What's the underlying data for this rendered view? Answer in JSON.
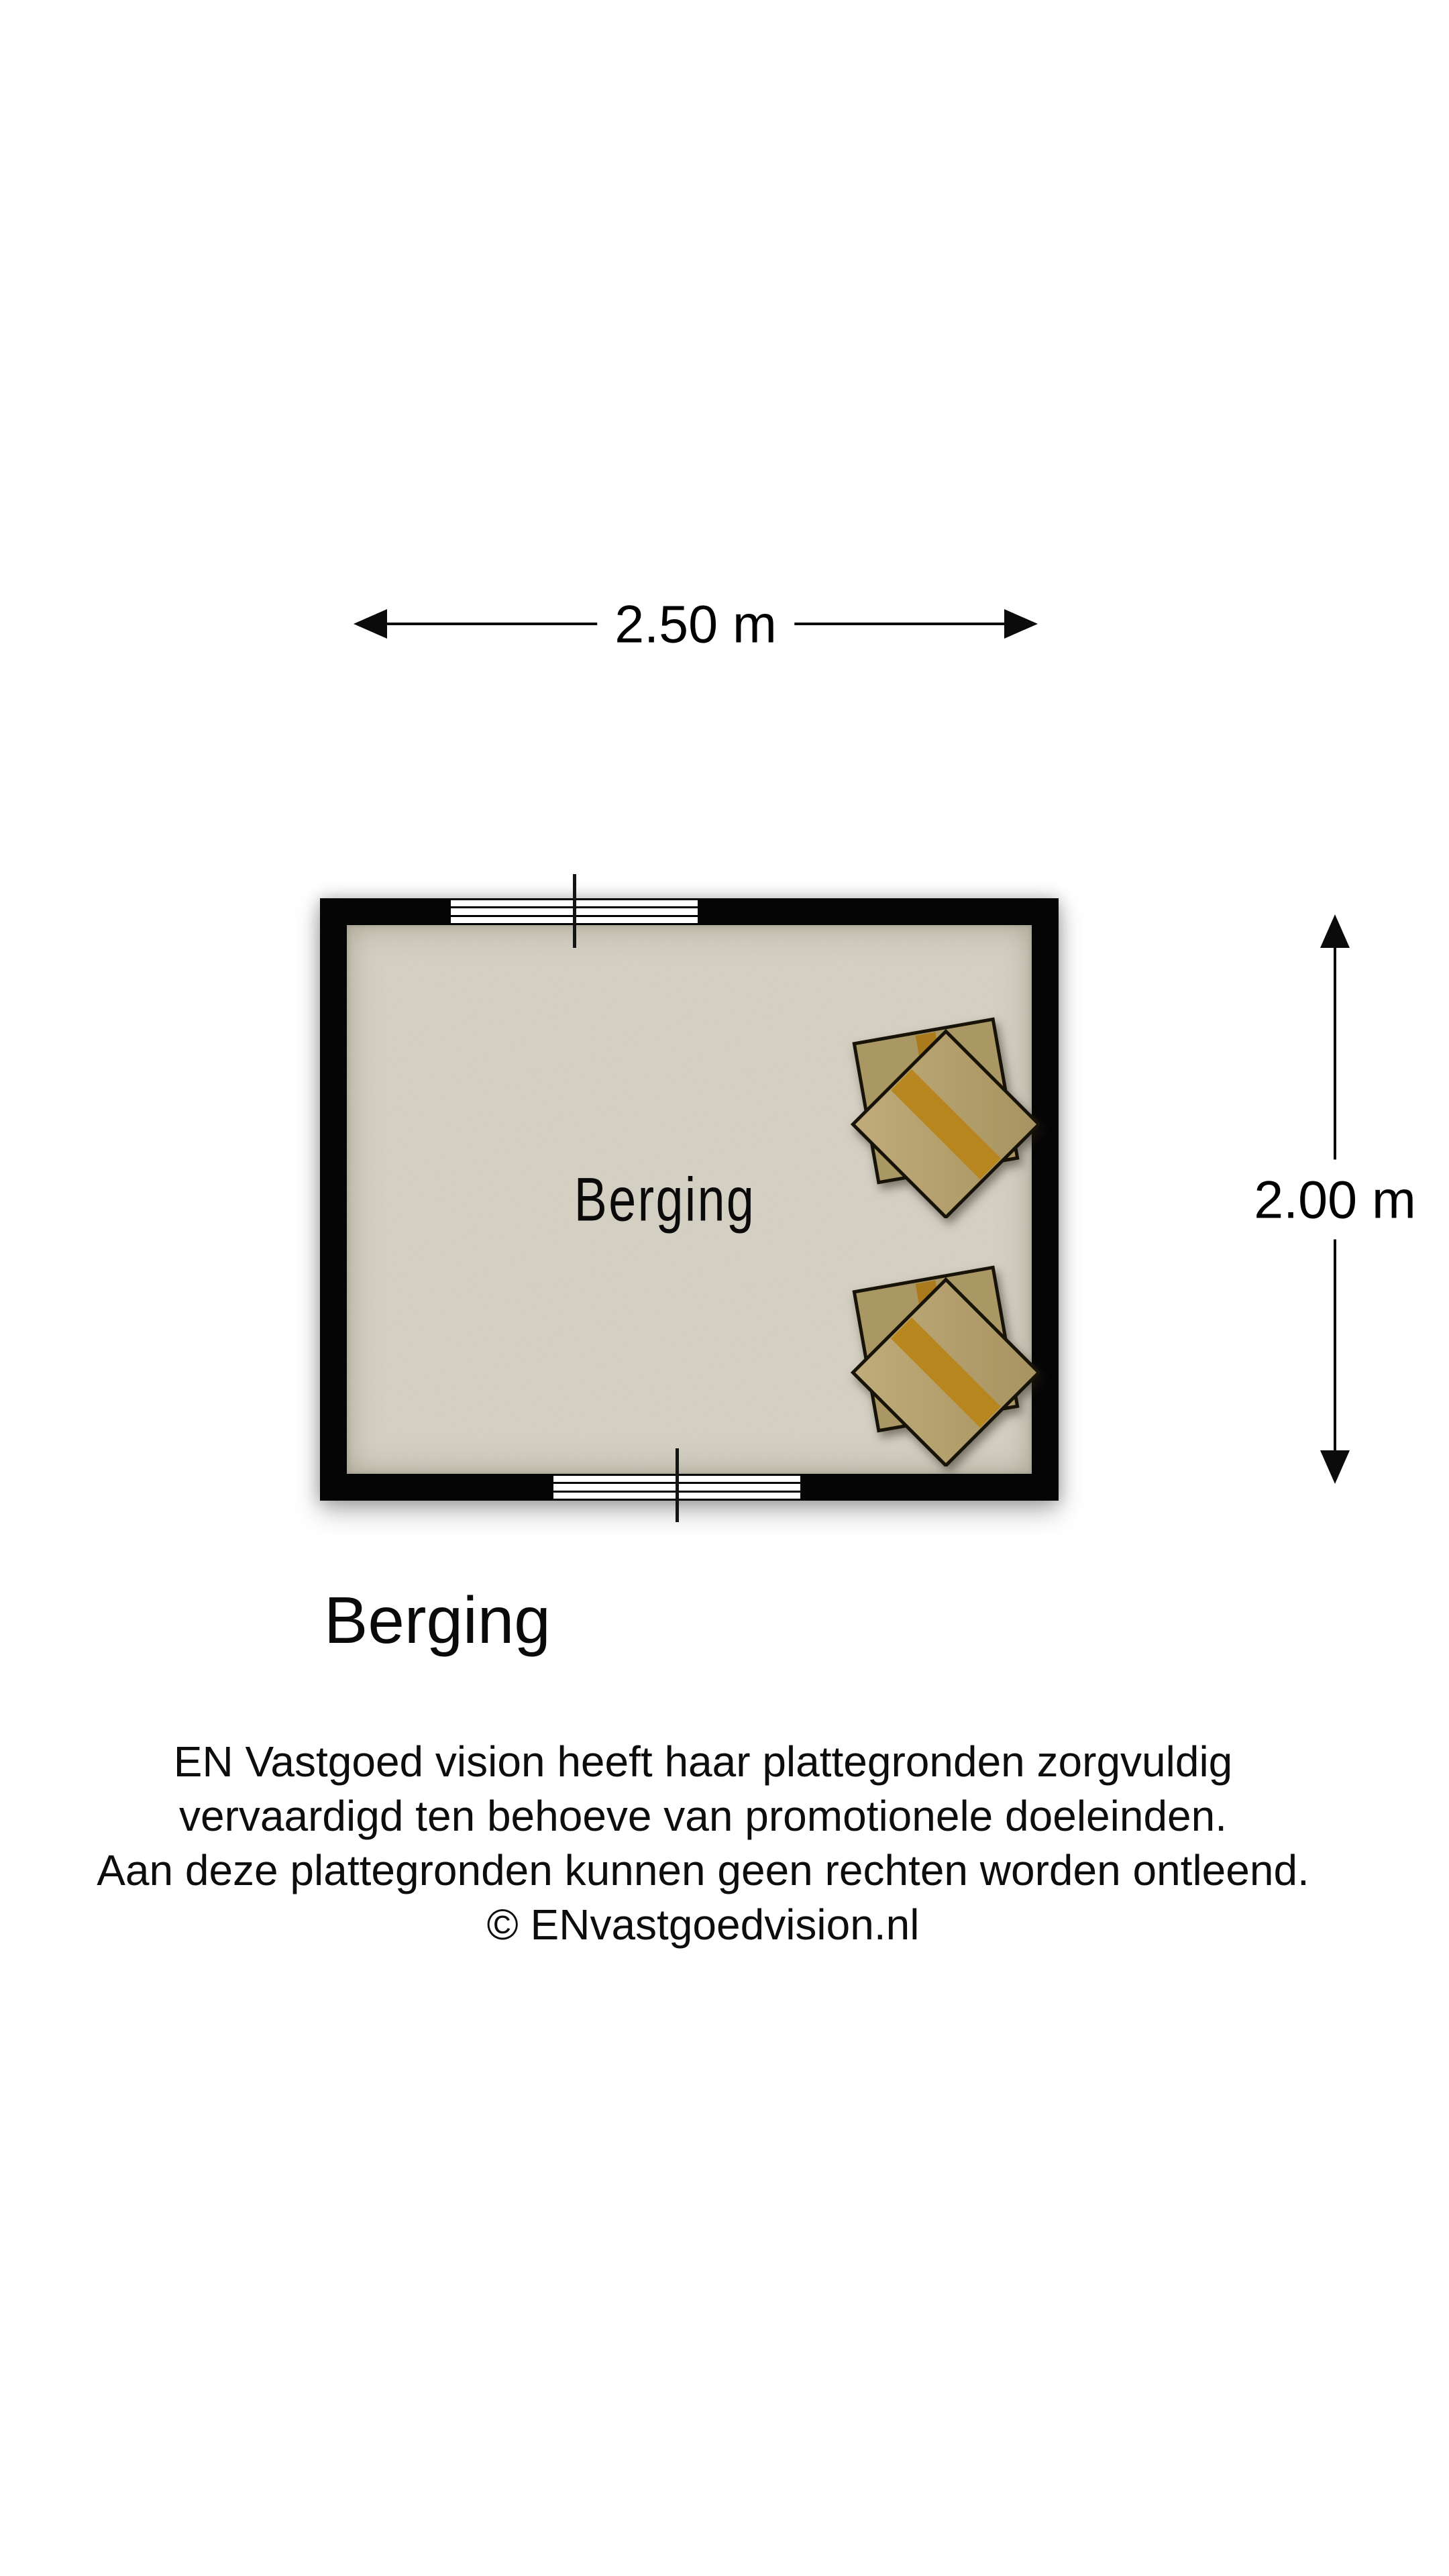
{
  "floor_plan": {
    "room_label": "Berging",
    "plan_title": "Berging",
    "dimensions": {
      "width": "2.50 m",
      "height": "2.00 m"
    },
    "objects": [
      {
        "name": "cardboard-boxes",
        "position": "top-right"
      },
      {
        "name": "cardboard-boxes",
        "position": "bottom-right"
      }
    ],
    "colors": {
      "wall": "#050505",
      "floor": "#d9d5c8",
      "box": "#a99764",
      "box_top": "#b4a271",
      "box_tape": "#b8861f",
      "dimension_text": "#000000"
    }
  },
  "disclaimer": {
    "lines": [
      "EN Vastgoed vision heeft haar plattegronden zorgvuldig",
      "vervaardigd ten behoeve van promotionele doeleinden.",
      "Aan deze plattegronden kunnen geen rechten worden ontleend.",
      "© ENvastgoedvision.nl"
    ]
  }
}
